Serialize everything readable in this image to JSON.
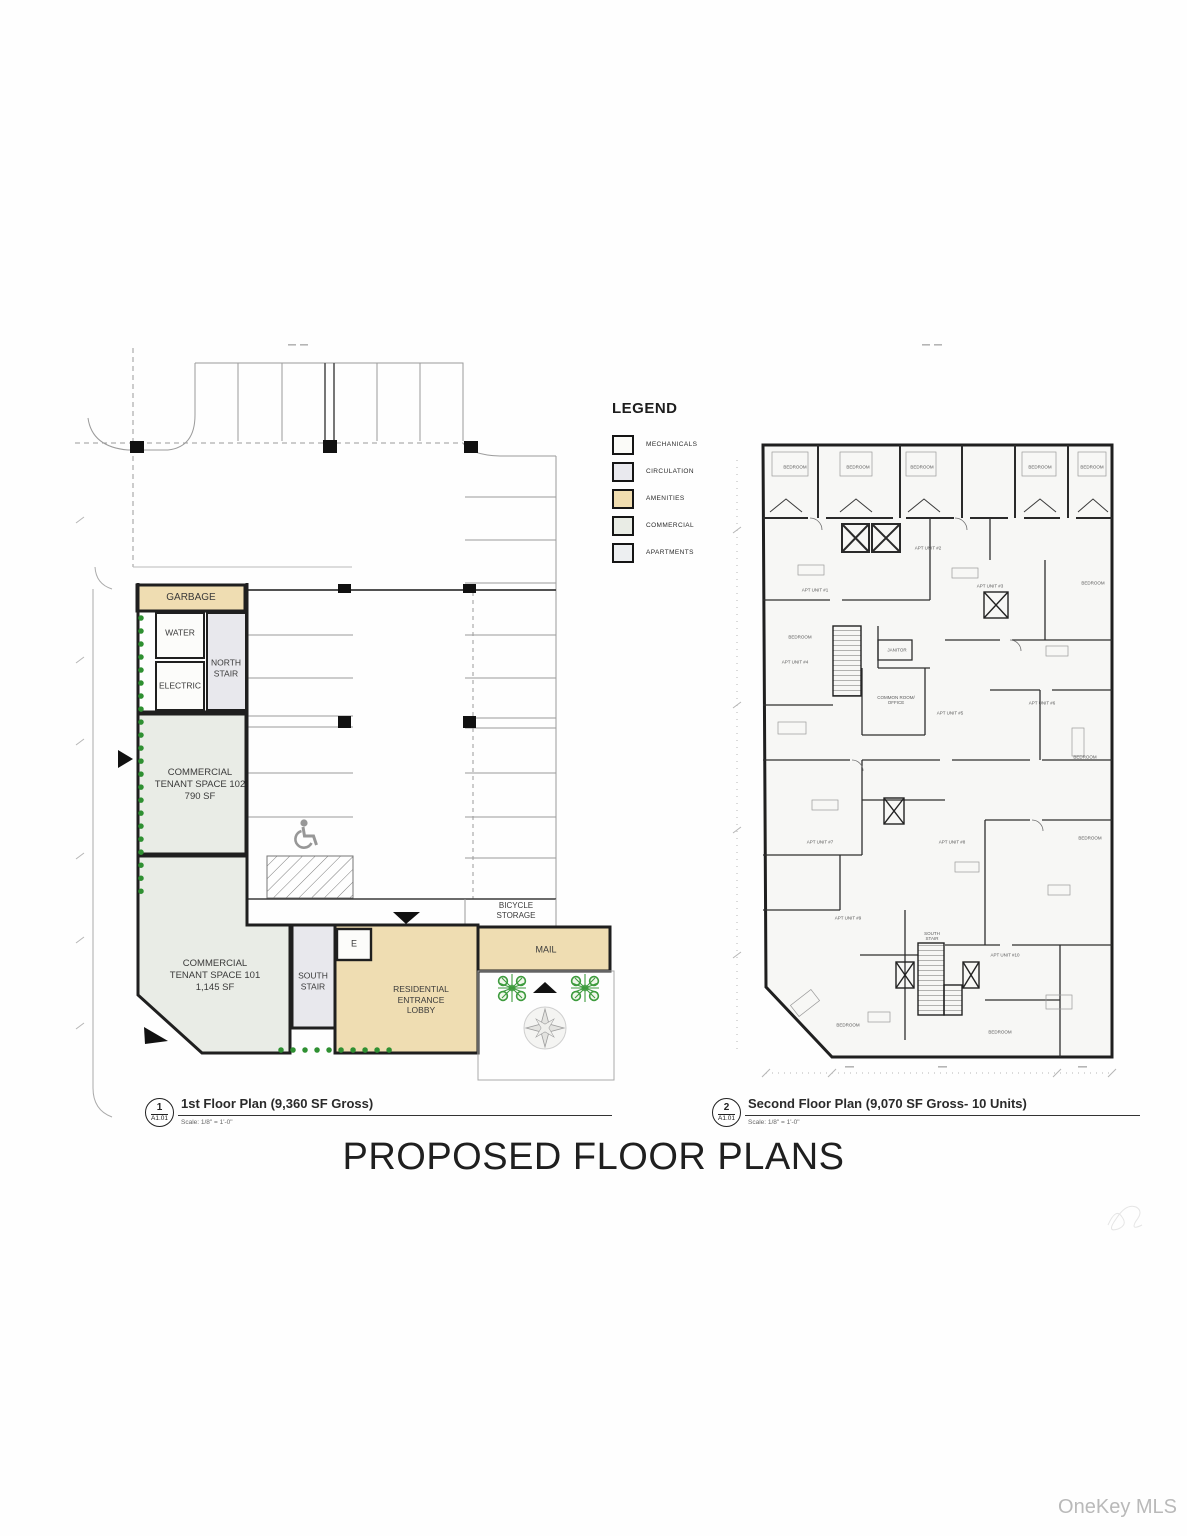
{
  "sheet": {
    "main_title": "PROPOSED FLOOR PLANS",
    "watermark": "OneKey MLS"
  },
  "legend": {
    "title": "LEGEND",
    "items": [
      {
        "label": "MECHANICALS",
        "color": "#fbfbf8"
      },
      {
        "label": "CIRCULATION",
        "color": "#e9e9ee"
      },
      {
        "label": "AMENITIES",
        "color": "#f0ddb0"
      },
      {
        "label": "COMMERCIAL",
        "color": "#e9ece5"
      },
      {
        "label": "APARTMENTS",
        "color": "#edeff1"
      }
    ]
  },
  "plan1": {
    "callout_number": "1",
    "sheet_number": "A1.01",
    "title": "1st Floor Plan (9,360 SF Gross)",
    "scale": "Scale: 1/8\" = 1'-0\"",
    "rooms": {
      "garbage": "GARBAGE",
      "water": "WATER",
      "electric": "ELECTRIC",
      "north_stair": "NORTH\nSTAIR",
      "commercial_102": "COMMERCIAL\nTENANT SPACE 102\n790 SF",
      "commercial_101": "COMMERCIAL\nTENANT SPACE 101\n1,145 SF",
      "south_stair": "SOUTH\nSTAIR",
      "elevator": "E",
      "lobby": "RESIDENTIAL\nENTRANCE\nLOBBY",
      "mail": "MAIL",
      "bicycle_storage": "BICYCLE\nSTORAGE"
    }
  },
  "plan2": {
    "callout_number": "2",
    "sheet_number": "A1.01",
    "title": "Second Floor Plan (9,070 SF Gross- 10 Units)",
    "scale": "Scale: 1/8\" = 1'-0\"",
    "bedroom_label": "BEDROOM",
    "janitor_label": "JANITOR",
    "common_room_label": "COMMON ROOM/\nOFFICE",
    "south_stair_label": "SOUTH\nSTAIR",
    "units": [
      "APT UNIT #1",
      "APT UNIT #2",
      "APT UNIT #3",
      "APT UNIT #4",
      "APT UNIT #5",
      "APT UNIT #6",
      "APT UNIT #7",
      "APT UNIT #8",
      "APT UNIT #9",
      "APT UNIT #10"
    ]
  },
  "colors": {
    "wall": "#1f1f1f",
    "amenities_fill": "#efddb2",
    "commercial_fill": "#e9ece6",
    "circulation_fill": "#e8e8ed",
    "landscape_green": "#2f9032",
    "parking_line_gray": "#9b9b9b"
  }
}
